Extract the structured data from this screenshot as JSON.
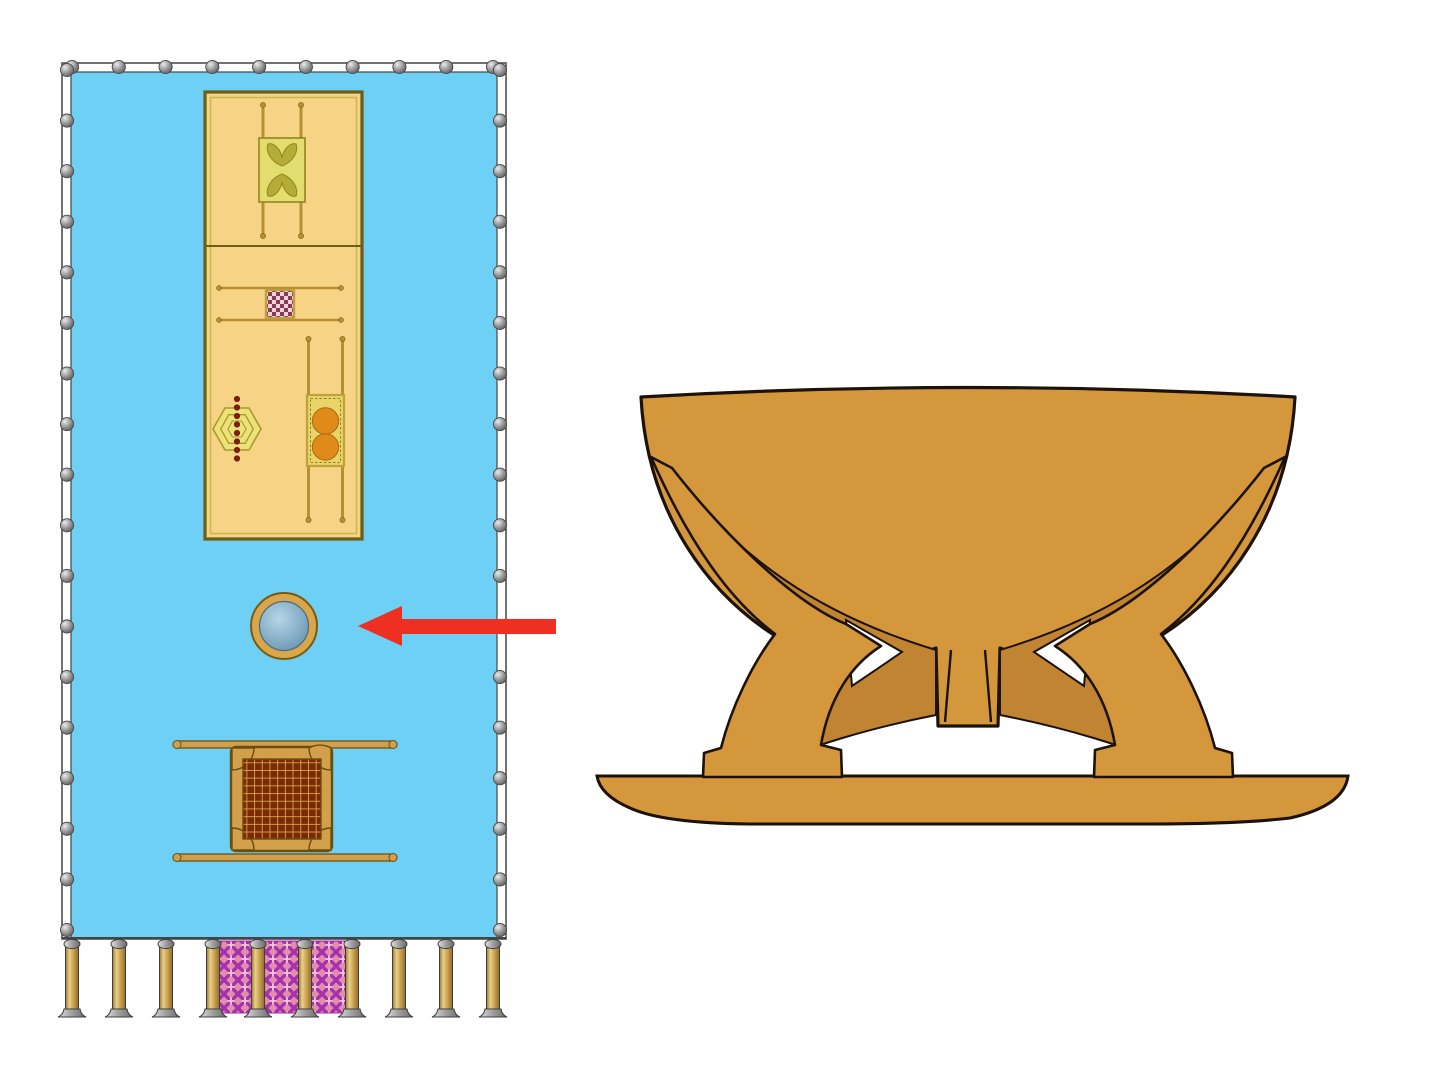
{
  "colors": {
    "page-bg": "#ffffff",
    "courtyard-blue": "#6FD0F5",
    "band-white": "#ffffff",
    "band-line": "#4f4f4f",
    "tabernacle-fill": "#F7D385",
    "tabernacle-border": "#6C5D17",
    "tabernacle-inner-line": "#C9B954",
    "gold-pole": "#C49A3E",
    "ark-fill": "#E3DC6E",
    "ark-border": "#8F861F",
    "cherub": "#B5AC38",
    "checker-dark": "#8C3A52",
    "checker-light": "#E8D5E0",
    "incense-border": "#BFA23C",
    "menorah-fill": "#EDE27A",
    "menorah-stroke": "#A79A2D",
    "menorah-dot": "#7A1F10",
    "table-fill": "#E8D469",
    "table-border": "#BFA23C",
    "bread": "#E08A1A",
    "laver-ring": "#D8A74B",
    "laver-ring-border": "#7A5A10",
    "water-light": "#A9CBDE",
    "water-dark": "#6F9DBA",
    "altar-frame": "#D2A04B",
    "altar-border": "#6B4E0F",
    "grate-bg": "#7B2A06",
    "grate-line": "#DCA94F",
    "pillar-cap": "#c9c9c9",
    "curtain-bg": "#E28DA9",
    "curtain-lattice": "#A431AE",
    "curtain-accent": "#F6C9D4",
    "curtain-border": "#9A2FA0",
    "arrow-red": "#EE3023",
    "bronze": "#D5973C",
    "bronze-dark": "#C08433",
    "outline": "#1C1208"
  },
  "courtyard": {
    "dots": {
      "top": {
        "count": 10,
        "x1": 72,
        "y1": 67,
        "x2": 493,
        "y2": 67
      },
      "left": {
        "count": 18,
        "x1": 67,
        "y1": 70,
        "x2": 67,
        "y2": 930
      },
      "right": {
        "count": 18,
        "x1": 500,
        "y1": 70,
        "x2": 500,
        "y2": 930
      }
    },
    "entrance": {
      "pillar_y": 941,
      "pillar_xs": [
        72,
        119,
        166,
        213,
        258,
        305,
        352,
        399,
        446,
        493
      ],
      "curtains": [
        {
          "x": 219,
          "w": 33
        },
        {
          "x": 264,
          "w": 35
        },
        {
          "x": 311,
          "w": 35
        }
      ]
    }
  },
  "elements": [
    {
      "icon": "courtyard-plan-icon"
    },
    {
      "icon": "tabernacle-tent-icon"
    },
    {
      "icon": "ark-of-covenant-icon"
    },
    {
      "icon": "incense-altar-icon"
    },
    {
      "icon": "menorah-icon"
    },
    {
      "icon": "showbread-table-icon"
    },
    {
      "icon": "laver-top-view-icon"
    },
    {
      "icon": "burnt-offering-altar-icon"
    },
    {
      "icon": "entrance-curtain-icon"
    },
    {
      "icon": "red-arrow-icon"
    },
    {
      "icon": "bronze-laver-side-view-icon"
    }
  ]
}
